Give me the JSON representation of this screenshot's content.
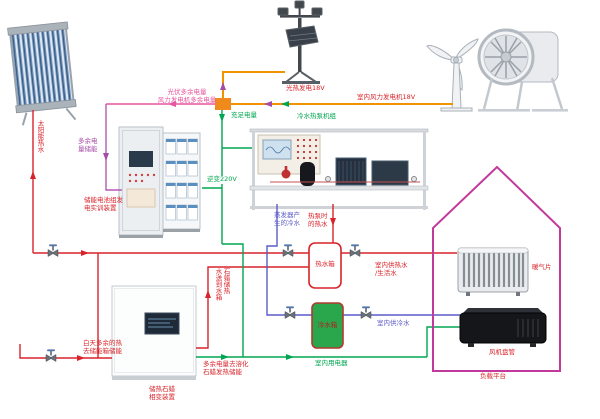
{
  "diagram_type": "renewable-energy hvac system schematic",
  "colors": {
    "hot_water_pipe": "#d9232a",
    "cold_water_pipe": "#5b5bc8",
    "electric_220v_line": "#00a651",
    "dc_bus_18v_line": "#f29200",
    "pv_excess_line": "#e8559e",
    "battery_charge_line": "#a64ca6",
    "house_outline": "#c2399b",
    "cold_tank_fill": "#2aa64c",
    "junction_box_fill": "#f08a1d"
  },
  "labels": {
    "solar_hot_water": "太阳能热水",
    "pv_excess_power": "光伏多余电量",
    "wind_excess_power": "风力发电机多余电量",
    "sufficient_power": "充足电量",
    "inverter_220v": "逆变220V",
    "solar_thermal_gen_18v": "光热发电18V",
    "indoor_wind_gen_18v": "室内风力发电机18V",
    "chiller_heat_pump_unit": "冷水热泵机组",
    "evaporator_cold_water": [
      "蒸发器产",
      "生的冷水"
    ],
    "heat_pump_hot_water": [
      "热泵时",
      "的热水"
    ],
    "hot_water_tank": "热水箱",
    "cold_water_tank": "冷水箱",
    "indoor_hot_supply": [
      "室内供热水",
      "/生活水"
    ],
    "indoor_cold_supply": "室内供冷水",
    "excess_power_storage": [
      "多余电",
      "量储能"
    ],
    "battery_training_device": [
      "储能电池组发",
      "电实训装置"
    ],
    "daytime_excess_heat": [
      "白天多余的热",
      "去储能箱储能"
    ],
    "paraffin_device": [
      "储热石蜡",
      "相变装置"
    ],
    "excess_power_melt_paraffin": [
      "多余电量去溶化",
      "石蜡发热储能"
    ],
    "paraffin_heat_to_tank": [
      "石蜡储热",
      "水送到水箱"
    ],
    "indoor_appliances": "室内用电器",
    "radiator": "暖气片",
    "fan_coil": "风机盘管",
    "load_platform": "负载平台"
  }
}
